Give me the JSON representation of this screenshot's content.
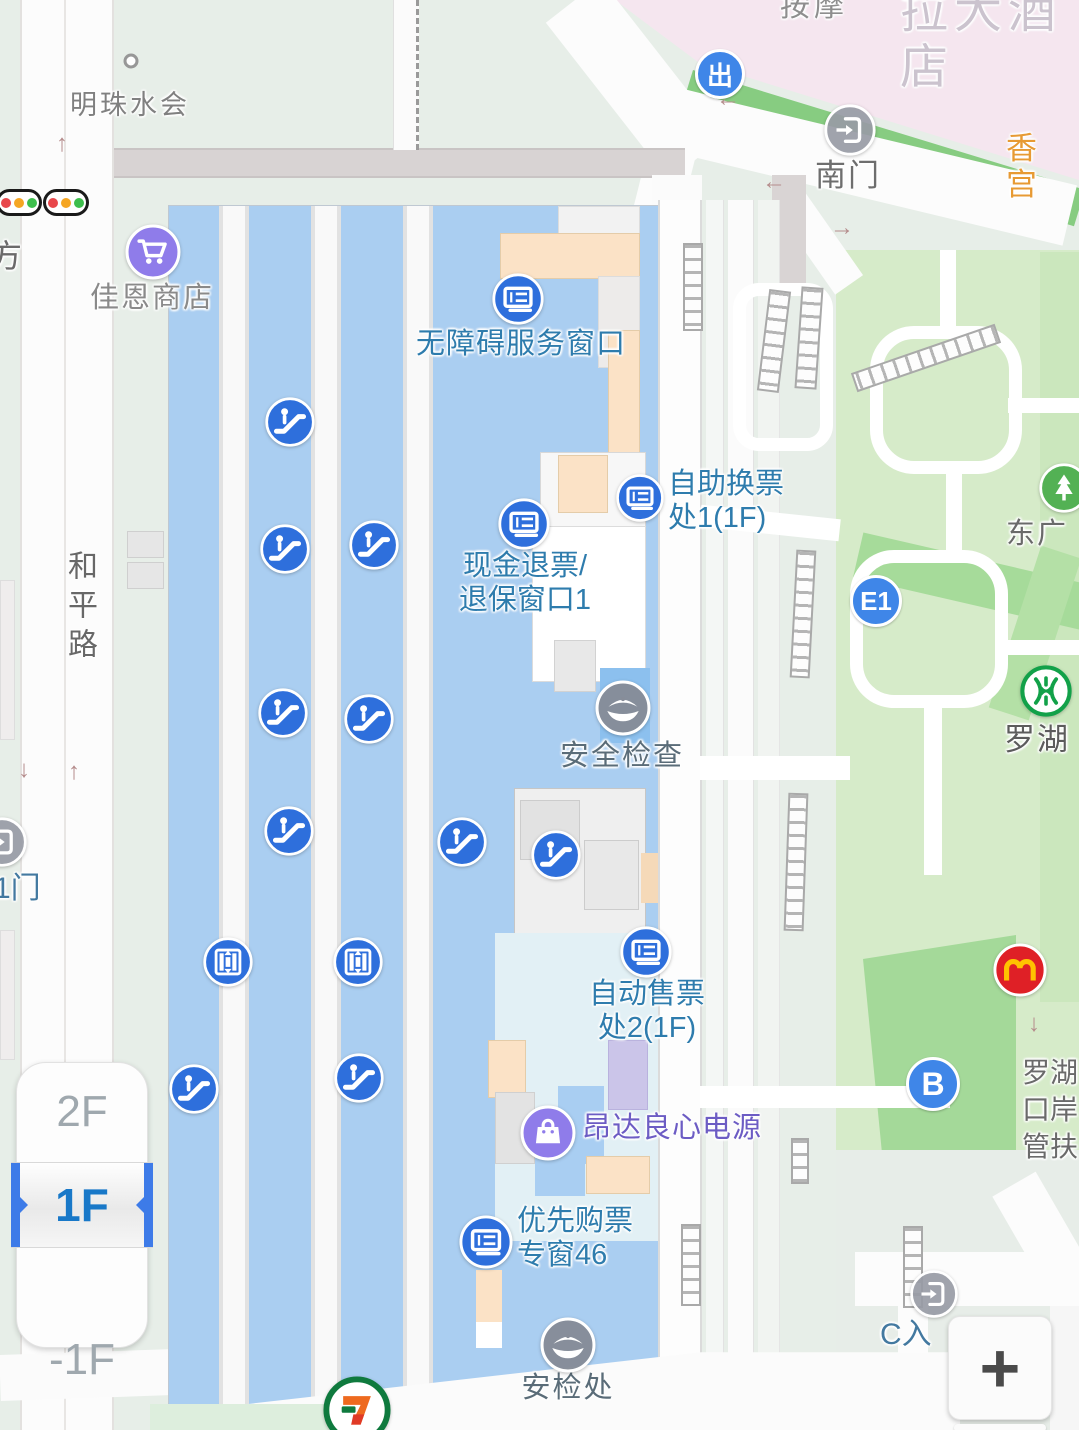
{
  "ui": {
    "floor_selector": {
      "floors": [
        "2F",
        "1F",
        "-1F"
      ],
      "selected": "1F"
    },
    "zoom_in_label": "+"
  },
  "map": {
    "colors": {
      "poi_blue": "#2E6FDC",
      "label_blue": "#2E7CAD",
      "label_gray": "#6E6E6E",
      "label_purple": "#6C5CC4",
      "label_orange": "#E79A33",
      "building_blue": "#AACEF1",
      "park_green": "#D6EBC9",
      "selected_floor_blue": "#1878C8"
    },
    "labels": [
      {
        "name": "hotel-label",
        "text": "拉大酒店",
        "x": 900,
        "y": -16,
        "size": 48,
        "color": "#CBC3CE",
        "align": "left",
        "ls": 6,
        "interactable": false
      },
      {
        "name": "massage-label",
        "text": "按摩",
        "x": 780,
        "y": -10,
        "size": 30,
        "color": "#8E8E8E",
        "align": "left",
        "ls": 4,
        "interactable": false
      },
      {
        "name": "mingzhu-club-label",
        "text": "明珠水会",
        "x": 130,
        "y": 90,
        "size": 27,
        "color": "#808080",
        "align": "center",
        "ls": 3,
        "interactable": false
      },
      {
        "name": "jiaen-store-label",
        "text": "佳恩商店",
        "x": 152,
        "y": 282,
        "size": 29,
        "color": "#8A8A8A",
        "align": "center",
        "ls": 2,
        "interactable": true
      },
      {
        "name": "barrier-free-window-label",
        "text": "无障碍服务窗口",
        "x": 521,
        "y": 328,
        "size": 29,
        "color": "#2E7CAD",
        "align": "center",
        "ls": 1,
        "interactable": true
      },
      {
        "name": "ticket-exchange-1-label",
        "text": "自助换票\n处1(1F)",
        "x": 668,
        "y": 468,
        "size": 29,
        "color": "#2E7CAD",
        "align": "left",
        "interactable": true
      },
      {
        "name": "cash-refund-window-label",
        "text": "现金退票/\n退保窗口1",
        "x": 525,
        "y": 550,
        "size": 29,
        "color": "#2E7CAD",
        "align": "center",
        "interactable": true
      },
      {
        "name": "security-check-label",
        "text": "安全检查",
        "x": 622,
        "y": 740,
        "size": 29,
        "color": "#5A6C78",
        "align": "center",
        "ls": 2,
        "interactable": true
      },
      {
        "name": "ticket-office-2-label",
        "text": "自动售票\n处2(1F)",
        "x": 647,
        "y": 978,
        "size": 29,
        "color": "#2E7CAD",
        "align": "center",
        "interactable": true
      },
      {
        "name": "angda-power-label",
        "text": "昂达良心电源",
        "x": 582,
        "y": 1112,
        "size": 29,
        "color": "#6C5CC4",
        "align": "left",
        "ls": 1,
        "interactable": true
      },
      {
        "name": "priority-ticket-window-label",
        "text": "优先购票\n专窗46",
        "x": 517,
        "y": 1205,
        "size": 29,
        "color": "#2E7CAD",
        "align": "left",
        "interactable": true
      },
      {
        "name": "security-checkpoint-label",
        "text": "安检处",
        "x": 568,
        "y": 1372,
        "size": 29,
        "color": "#5A6C78",
        "align": "center",
        "ls": 2,
        "interactable": true
      },
      {
        "name": "heping-road-label",
        "text": "和平路",
        "x": 64,
        "y": 550,
        "size": 30,
        "color": "#686868",
        "vertical": true,
        "ls": 9,
        "interactable": false
      },
      {
        "name": "south-gate-label",
        "text": "南门",
        "x": 848,
        "y": 158,
        "size": 31,
        "color": "#6E6E6E",
        "align": "center",
        "ls": 2,
        "interactable": true
      },
      {
        "name": "xianggong-label",
        "text": "香宫",
        "x": 1023,
        "y": 131,
        "size": 31,
        "color": "#E79A33",
        "align": "center",
        "ls": 3,
        "interactable": true
      },
      {
        "name": "east-plaza-label",
        "text": "东广",
        "x": 1006,
        "y": 518,
        "size": 29,
        "color": "#6A6A6A",
        "align": "left",
        "ls": 2,
        "interactable": false
      },
      {
        "name": "luohu-metro-label",
        "text": "罗湖",
        "x": 1004,
        "y": 722,
        "size": 31,
        "color": "#5C5C5C",
        "align": "left",
        "ls": 2,
        "interactable": true
      },
      {
        "name": "luohu-port-label",
        "text": "罗湖\n口岸\n管扶",
        "x": 1022,
        "y": 1055,
        "size": 28,
        "color": "#6A6A6A",
        "align": "left",
        "lh": 1.32,
        "interactable": false
      },
      {
        "name": "c-entrance-label",
        "text": "C入",
        "x": 880,
        "y": 1318,
        "size": 30,
        "color": "#4379A0",
        "align": "left",
        "interactable": true
      },
      {
        "name": "gate-1-label",
        "text": "1门",
        "x": -6,
        "y": 872,
        "size": 30,
        "color": "#4379A0",
        "align": "left",
        "interactable": true
      },
      {
        "name": "fang-label",
        "text": "方",
        "x": -10,
        "y": 238,
        "size": 32,
        "color": "#6A6A6A",
        "align": "left",
        "interactable": false
      }
    ],
    "markers": [
      {
        "type": "ticket",
        "x": 518,
        "y": 299,
        "size": 54
      },
      {
        "type": "ticket",
        "x": 524,
        "y": 524,
        "size": 54
      },
      {
        "type": "ticket",
        "x": 640,
        "y": 498,
        "size": 50
      },
      {
        "type": "ticket",
        "x": 646,
        "y": 952,
        "size": 54
      },
      {
        "type": "ticket",
        "x": 486,
        "y": 1242,
        "size": 56
      },
      {
        "type": "escalator",
        "x": 290,
        "y": 422,
        "size": 52
      },
      {
        "type": "escalator",
        "x": 285,
        "y": 549,
        "size": 52
      },
      {
        "type": "escalator",
        "x": 374,
        "y": 545,
        "size": 52
      },
      {
        "type": "escalator",
        "x": 283,
        "y": 713,
        "size": 52
      },
      {
        "type": "escalator",
        "x": 369,
        "y": 719,
        "size": 52
      },
      {
        "type": "escalator",
        "x": 289,
        "y": 831,
        "size": 52
      },
      {
        "type": "escalator",
        "x": 462,
        "y": 842,
        "size": 52
      },
      {
        "type": "escalator",
        "x": 556,
        "y": 855,
        "size": 52
      },
      {
        "type": "escalator",
        "x": 194,
        "y": 1089,
        "size": 52
      },
      {
        "type": "escalator",
        "x": 359,
        "y": 1078,
        "size": 52
      },
      {
        "type": "elevator",
        "x": 228,
        "y": 962,
        "size": 52
      },
      {
        "type": "elevator",
        "x": 358,
        "y": 962,
        "size": 52
      },
      {
        "type": "security",
        "x": 623,
        "y": 708,
        "size": 58
      },
      {
        "type": "security",
        "x": 568,
        "y": 1345,
        "size": 58
      },
      {
        "type": "gate",
        "x": 850,
        "y": 130,
        "size": 54
      },
      {
        "type": "gate",
        "x": 934,
        "y": 1294,
        "size": 50
      },
      {
        "type": "gate",
        "x": 2,
        "y": 842,
        "size": 52
      },
      {
        "type": "cart",
        "x": 153,
        "y": 252,
        "size": 58
      },
      {
        "type": "bag",
        "x": 548,
        "y": 1133,
        "size": 58
      },
      {
        "type": "tree",
        "x": 1064,
        "y": 488,
        "size": 52
      },
      {
        "type": "metro",
        "x": 1046,
        "y": 691,
        "size": 54
      },
      {
        "type": "mcdonalds",
        "x": 1020,
        "y": 970,
        "size": 56
      },
      {
        "type": "seven",
        "x": 357,
        "y": 1410,
        "size": 70
      },
      {
        "type": "traffic",
        "x": 19,
        "y": 212,
        "size": 46,
        "interactable": false
      },
      {
        "type": "traffic",
        "x": 66,
        "y": 212,
        "size": 46,
        "interactable": false
      },
      {
        "type": "poidot",
        "x": 131,
        "y": 61,
        "size": 15,
        "interactable": false
      }
    ],
    "badges": [
      {
        "text": "出",
        "x": 720,
        "y": 74,
        "size": 50,
        "fs": 26
      },
      {
        "text": "E1",
        "x": 876,
        "y": 601,
        "size": 52,
        "fs": 26
      },
      {
        "text": "B",
        "x": 933,
        "y": 1084,
        "size": 54,
        "fs": 32
      }
    ],
    "arrows": [
      {
        "glyph": "↑",
        "x": 62,
        "y": 144
      },
      {
        "glyph": "↓",
        "x": 24,
        "y": 770
      },
      {
        "glyph": "↑",
        "x": 74,
        "y": 772
      },
      {
        "glyph": "←",
        "x": 728,
        "y": 99
      },
      {
        "glyph": "←",
        "x": 774,
        "y": 182
      },
      {
        "glyph": "→",
        "x": 842,
        "y": 228
      },
      {
        "glyph": "↓",
        "x": 1034,
        "y": 1024
      }
    ],
    "ladders": [
      {
        "x": 683,
        "y": 243,
        "w": 20,
        "h": 88,
        "rot": 0
      },
      {
        "x": 763,
        "y": 290,
        "w": 22,
        "h": 102,
        "rot": 7
      },
      {
        "x": 798,
        "y": 287,
        "w": 22,
        "h": 102,
        "rot": 4
      },
      {
        "x": 916,
        "y": 282,
        "w": 20,
        "h": 152,
        "rot": 71
      },
      {
        "x": 793,
        "y": 550,
        "w": 20,
        "h": 128,
        "rot": 3
      },
      {
        "x": 786,
        "y": 793,
        "w": 20,
        "h": 138,
        "rot": 2
      },
      {
        "x": 791,
        "y": 1138,
        "w": 18,
        "h": 46,
        "rot": 0
      },
      {
        "x": 903,
        "y": 1226,
        "w": 20,
        "h": 82,
        "rot": 0
      },
      {
        "x": 681,
        "y": 1224,
        "w": 20,
        "h": 82,
        "rot": 0
      }
    ]
  }
}
